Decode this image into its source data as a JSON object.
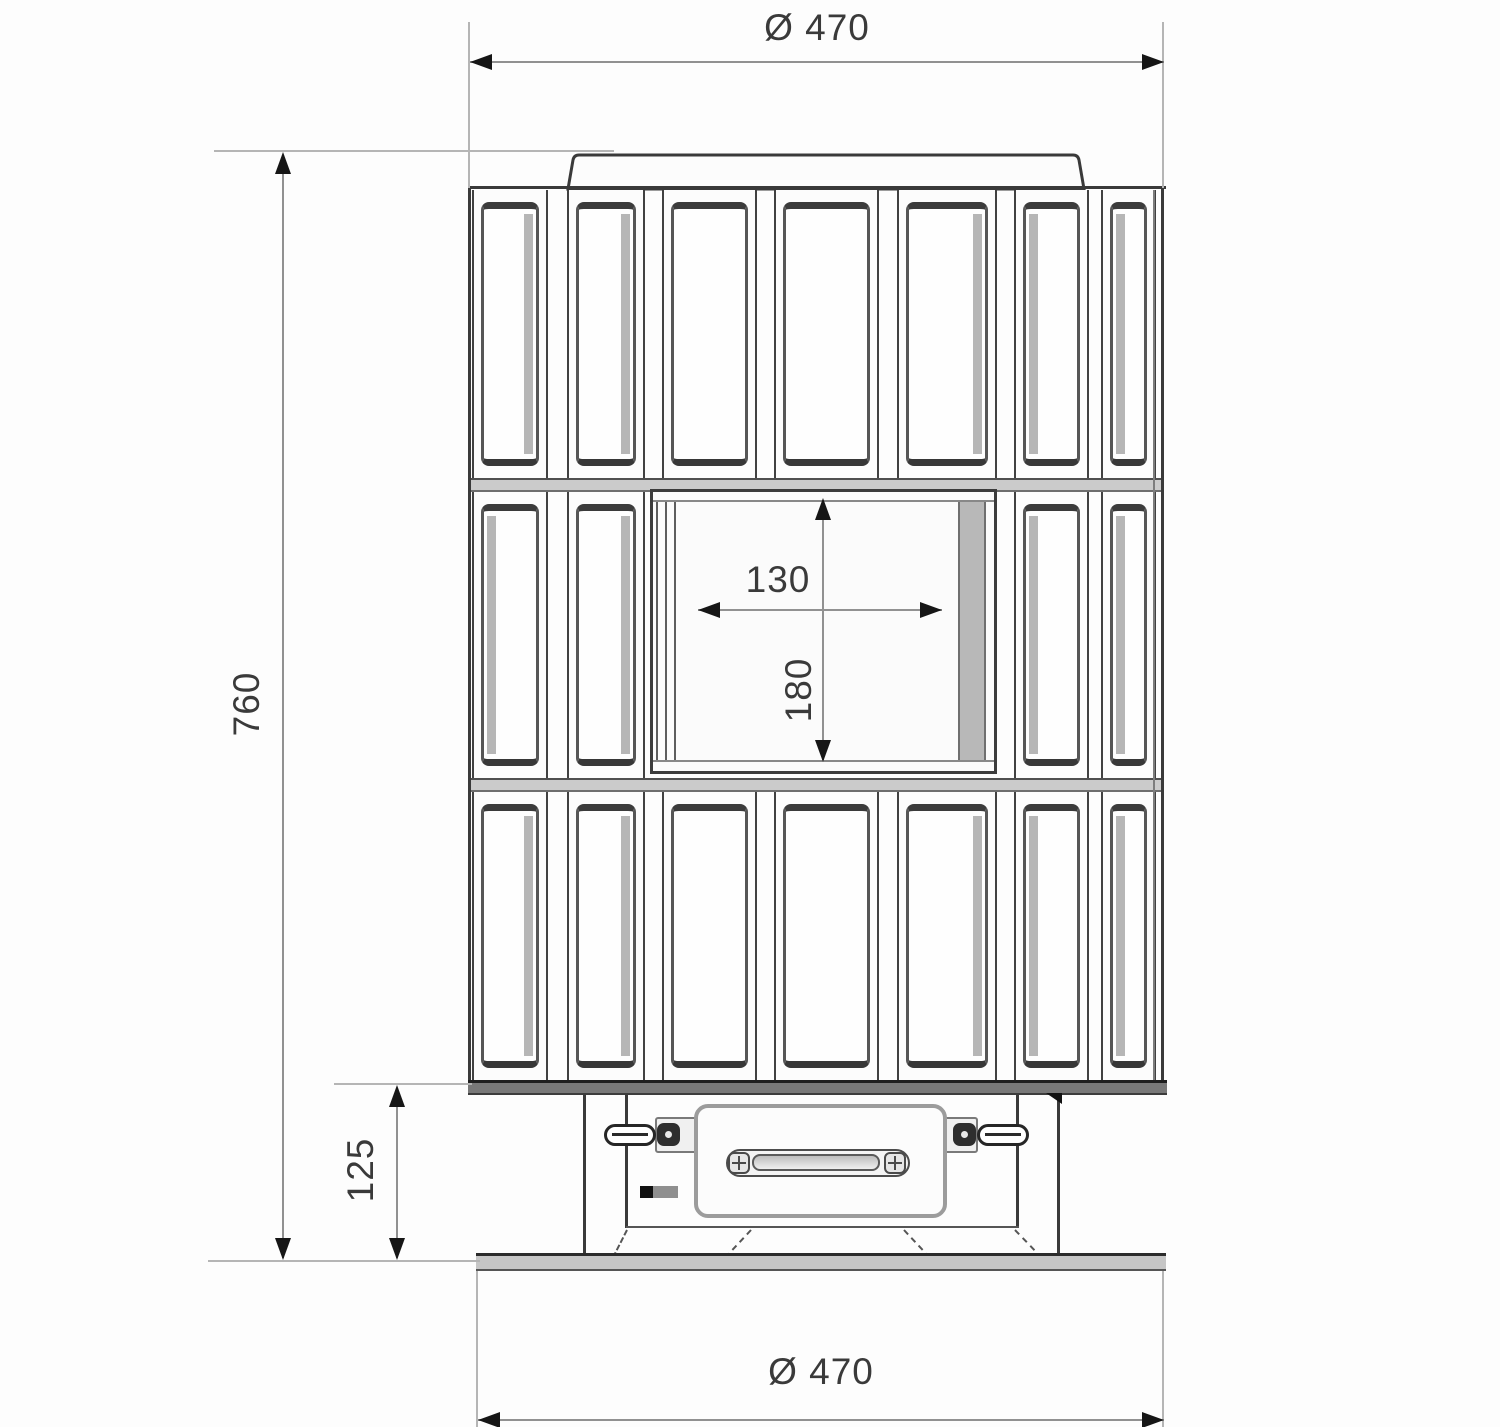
{
  "drawing": {
    "dimensions": {
      "top_diameter": "Ø 470",
      "overall_height": "760",
      "opening_width": "130",
      "opening_height": "180",
      "plinth_height": "125",
      "bottom_diameter": "Ø 470"
    }
  }
}
